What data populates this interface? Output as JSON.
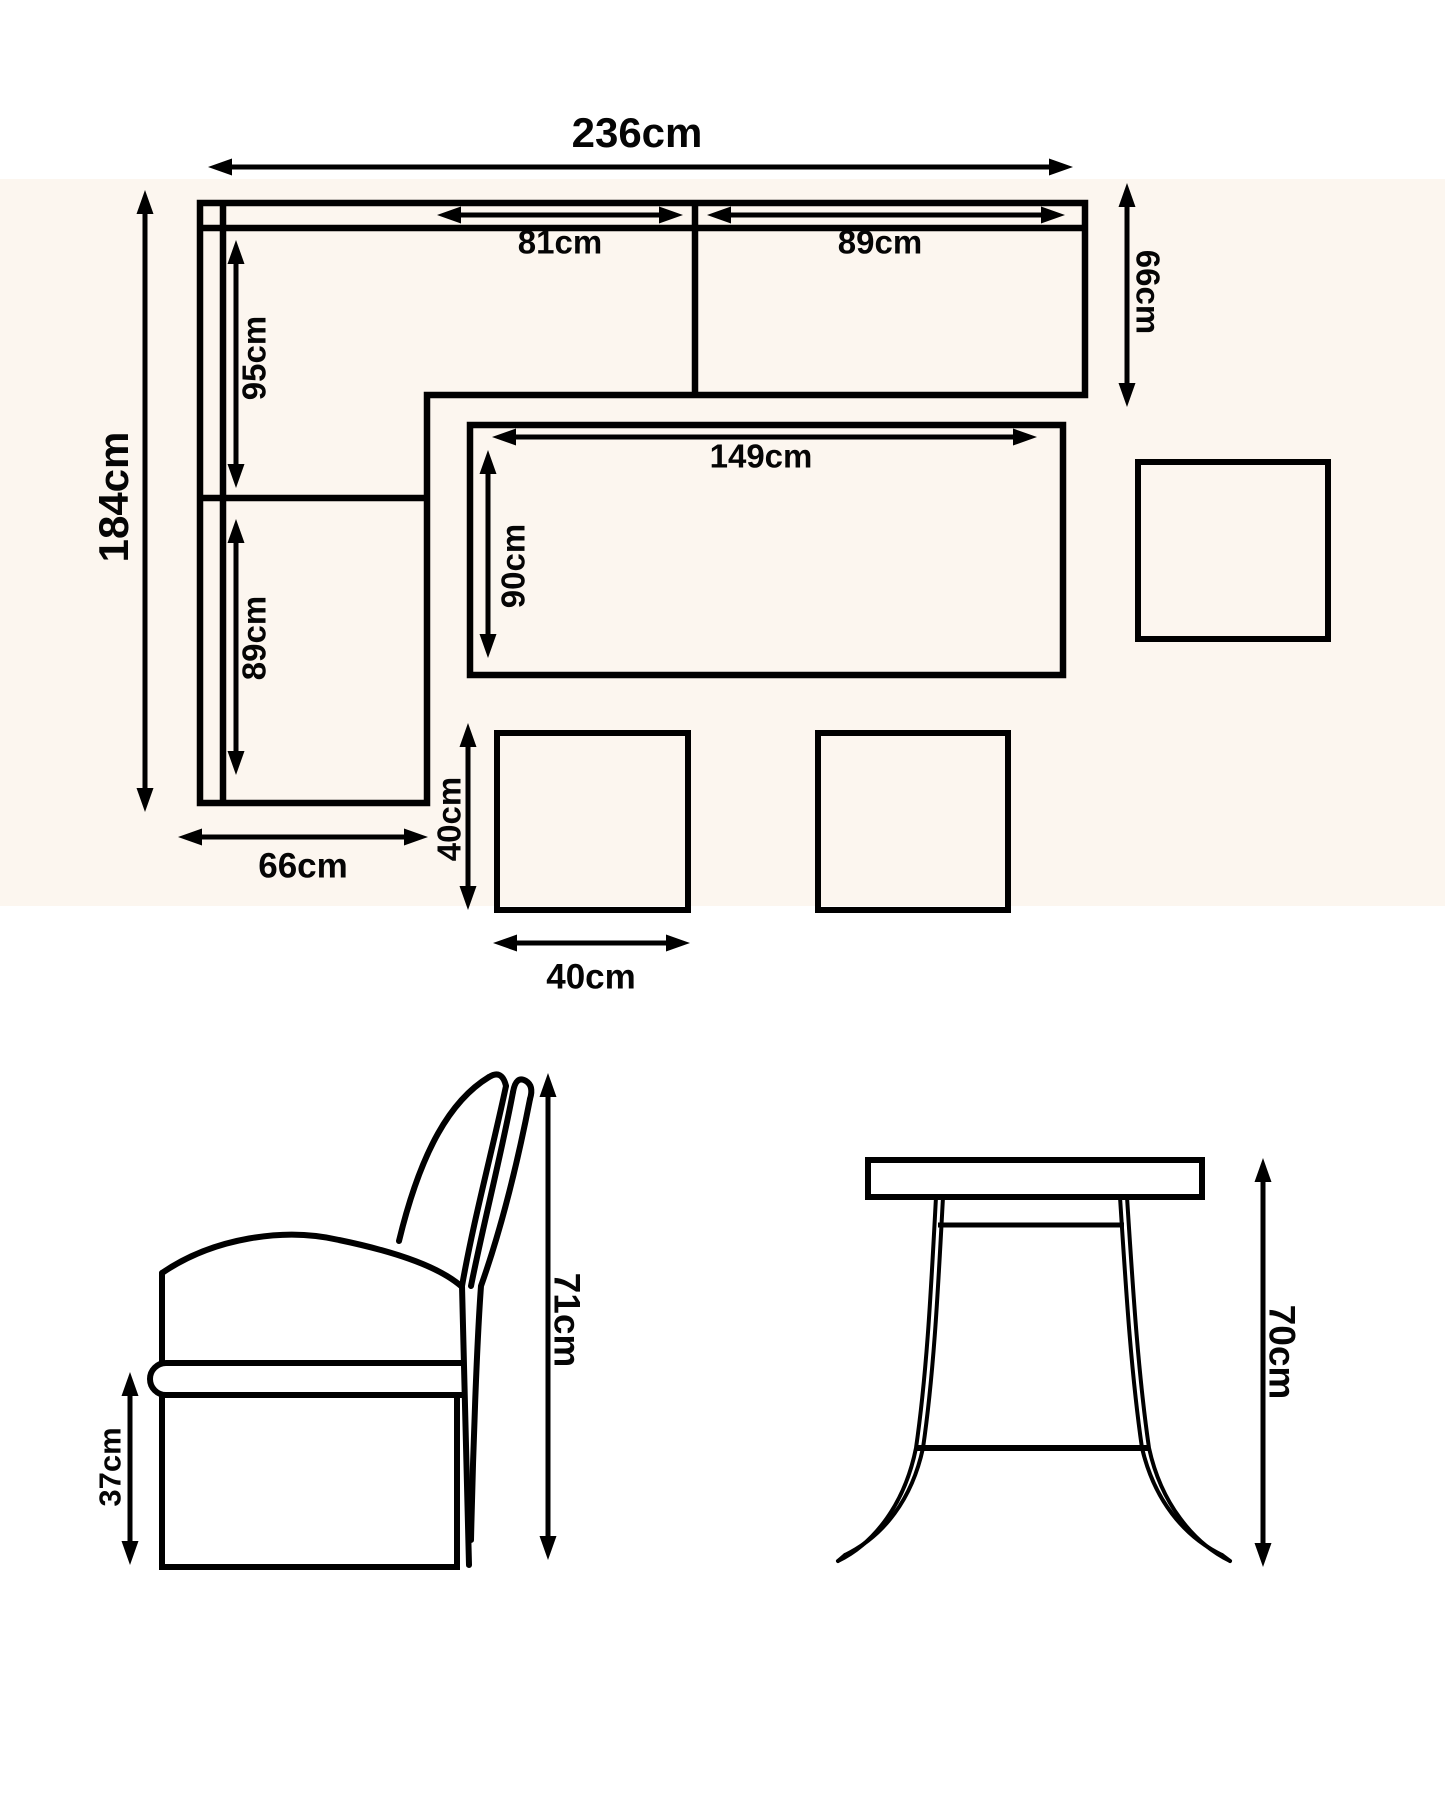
{
  "page": {
    "background": "#FFFFFF",
    "plan_view_background": "#FCF6EF",
    "line_color": "#000000"
  },
  "plan_view": {
    "sofa": {
      "overall_width": "236cm",
      "overall_depth": "184cm",
      "top_section_left_width": "81cm",
      "top_section_right_width": "89cm",
      "right_arm_depth": "66cm",
      "left_section_upper_length": "95cm",
      "left_section_lower_length": "89cm",
      "left_arm_width": "66cm"
    },
    "table": {
      "length": "149cm",
      "width": "90cm"
    },
    "stool": {
      "width": "40cm",
      "depth": "40cm"
    }
  },
  "side_view": {
    "chair": {
      "overall_height": "71cm",
      "seat_height": "37cm"
    },
    "table": {
      "height": "70cm"
    }
  }
}
